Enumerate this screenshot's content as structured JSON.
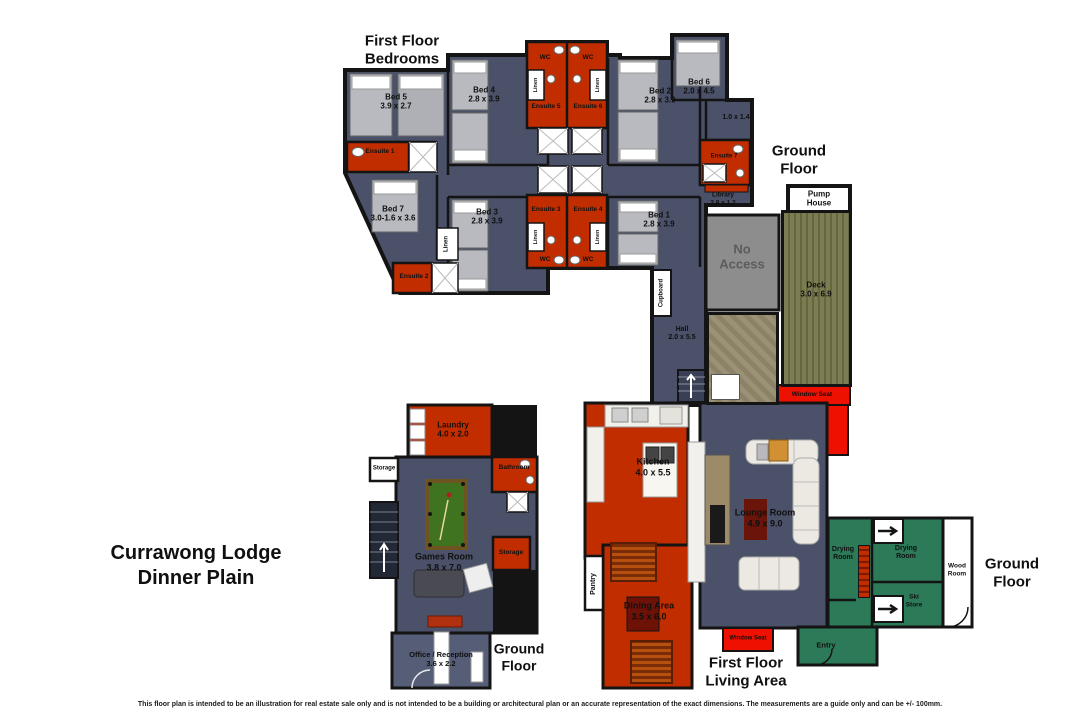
{
  "meta": {
    "title_line1": "Currawong Lodge",
    "title_line2": "Dinner Plain",
    "disclaimer": "This floor plan is intended to be an illustration for real estate sale only and is not intended to be a building or architectural plan or an accurate representation of the exact dimensions. The measurements are a guide only and can be +/- 100mm."
  },
  "headings": {
    "bedrooms": {
      "l1": "First Floor",
      "l2": "Bedrooms"
    },
    "living": {
      "l1": "First Floor",
      "l2": "Living Area"
    },
    "ground": {
      "l1": "Ground",
      "l2": "Floor"
    }
  },
  "shared": {
    "wc": "WC",
    "linen": "Linen",
    "storage": "Storage",
    "window_seat": "Window Seat",
    "drying": {
      "l1": "Drying",
      "l2": "Room"
    }
  },
  "rooms": {
    "bed1": {
      "name": "Bed 1",
      "dims": "2.8 x 3.9"
    },
    "bed2": {
      "name": "Bed 2",
      "dims": "2.8 x 3.9"
    },
    "bed3": {
      "name": "Bed 3",
      "dims": "2.8 x 3.9"
    },
    "bed4": {
      "name": "Bed 4",
      "dims": "2.8 x 3.9"
    },
    "bed5": {
      "name": "Bed 5",
      "dims": "3.9 x 2.7"
    },
    "bed6": {
      "name": "Bed 6",
      "dims": "2.0 x 4.5"
    },
    "bed7": {
      "name": "Bed 7",
      "dims": "3.0-1.6 x 3.6"
    },
    "ensuite1": {
      "name": "Ensuite 1"
    },
    "ensuite2": {
      "name": "Ensuite 2"
    },
    "ensuite3": {
      "name": "Ensuite 3"
    },
    "ensuite4": {
      "name": "Ensuite 4"
    },
    "ensuite5": {
      "name": "Ensuite 5"
    },
    "ensuite6": {
      "name": "Ensuite 6"
    },
    "ensuite7": {
      "name": "Ensuite 7"
    },
    "library": {
      "name": "Library",
      "dims": "2.8 x 1.2"
    },
    "balcony": {
      "dims": "1.0 x 1.4"
    },
    "hall": {
      "name": "Hall",
      "dims": "2.0 x 5.5"
    },
    "cupboard": {
      "name": "Cupboard"
    },
    "pump_house": {
      "l1": "Pump",
      "l2": "House"
    },
    "no_access": {
      "l1": "No",
      "l2": "Access"
    },
    "deck": {
      "name": "Deck",
      "dims": "3.0 x 6.9"
    },
    "kitchen": {
      "name": "Kitchen",
      "dims": "4.0 x 5.5"
    },
    "pantry": {
      "name": "Pantry"
    },
    "lounge": {
      "name": "Lounge Room",
      "dims": "4.9 x 9.0"
    },
    "dining": {
      "name": "Dining Area",
      "dims": "3.5 x 6.0"
    },
    "laundry": {
      "name": "Laundry",
      "dims": "4.0 x 2.0"
    },
    "bathroom": {
      "name": "Bathroom"
    },
    "games": {
      "name": "Games Room",
      "dims": "3.8 x 7.0"
    },
    "office": {
      "name": "Office / Reception",
      "dims": "3.6 x 2.2"
    },
    "wood": {
      "l1": "Wood",
      "l2": "Room"
    },
    "ski": {
      "l1": "Ski",
      "l2": "Store"
    },
    "entry": {
      "name": "Entry"
    }
  },
  "colors": {
    "floor_dark_slate": "#4a5168",
    "floor_office": "#565d76",
    "room_red": "#c22d00",
    "window_seat_red": "#ee1000",
    "deck_olive": "#7c7c52",
    "no_access_gray": "#8d8d8d",
    "stone_path": "#9a9176",
    "ground_green": "#2c7a58",
    "pool_table_green": "#3f7320",
    "wall_black": "#141414"
  }
}
